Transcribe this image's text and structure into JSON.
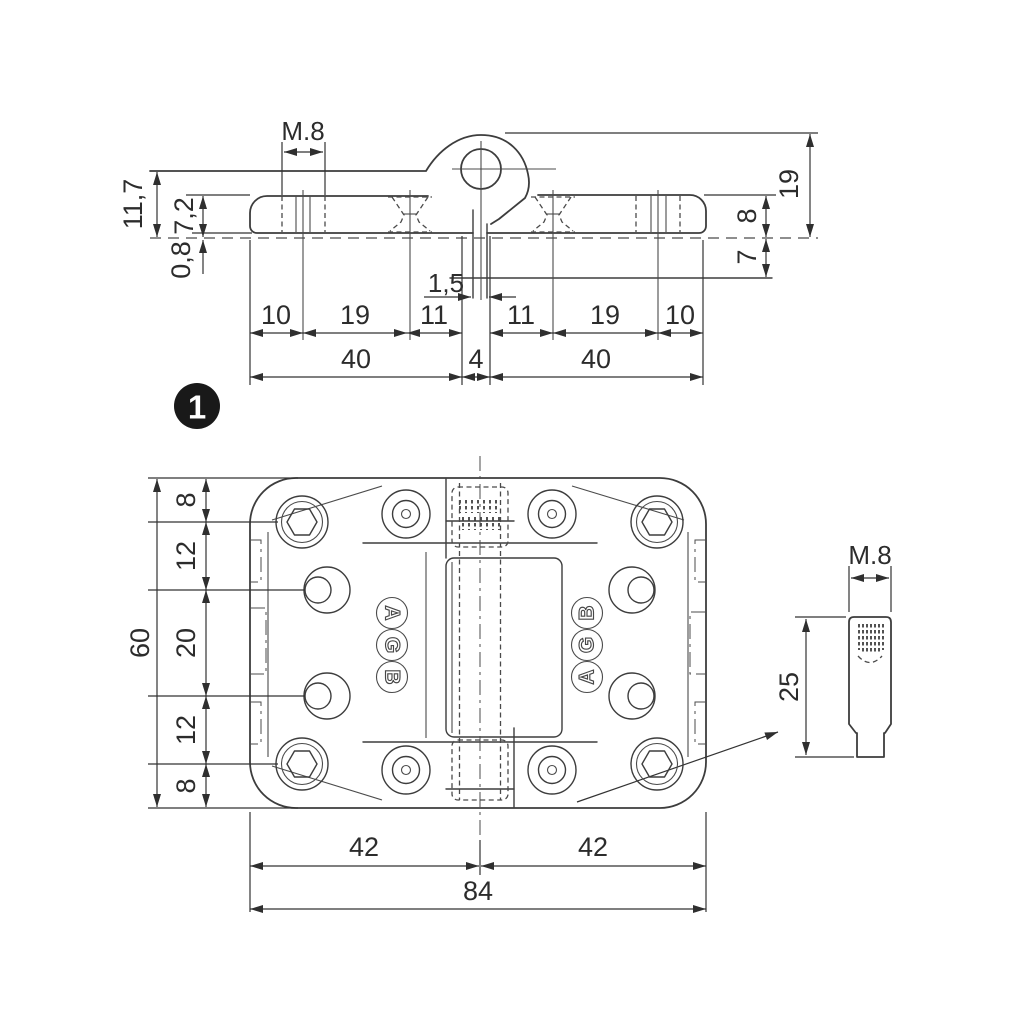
{
  "figure": {
    "badge_label": "1",
    "brand_letters": [
      "A",
      "G",
      "B"
    ],
    "top_view": {
      "thread_label": "M.8",
      "left_dims": {
        "total_height": "11,7",
        "plate_height": "7,2",
        "gap": "0,8"
      },
      "slot_width": "1,5",
      "chain": [
        "10",
        "19",
        "11",
        "11",
        "19",
        "10"
      ],
      "totals": [
        "40",
        "4",
        "40"
      ],
      "right_dims": {
        "knuckle_height": "19",
        "plate_top": "8",
        "plate_bottom": "7"
      }
    },
    "plan_view": {
      "height_total": "60",
      "height_chain": [
        "8",
        "12",
        "20",
        "12",
        "8"
      ],
      "width_halves": [
        "42",
        "42"
      ],
      "width_total": "84"
    },
    "pin_detail": {
      "thread_label": "M.8",
      "length": "25"
    },
    "colors": {
      "background": "#ffffff",
      "line": "#3d3d3d",
      "text": "#2c2c2c",
      "badge_bg": "#191919"
    }
  }
}
